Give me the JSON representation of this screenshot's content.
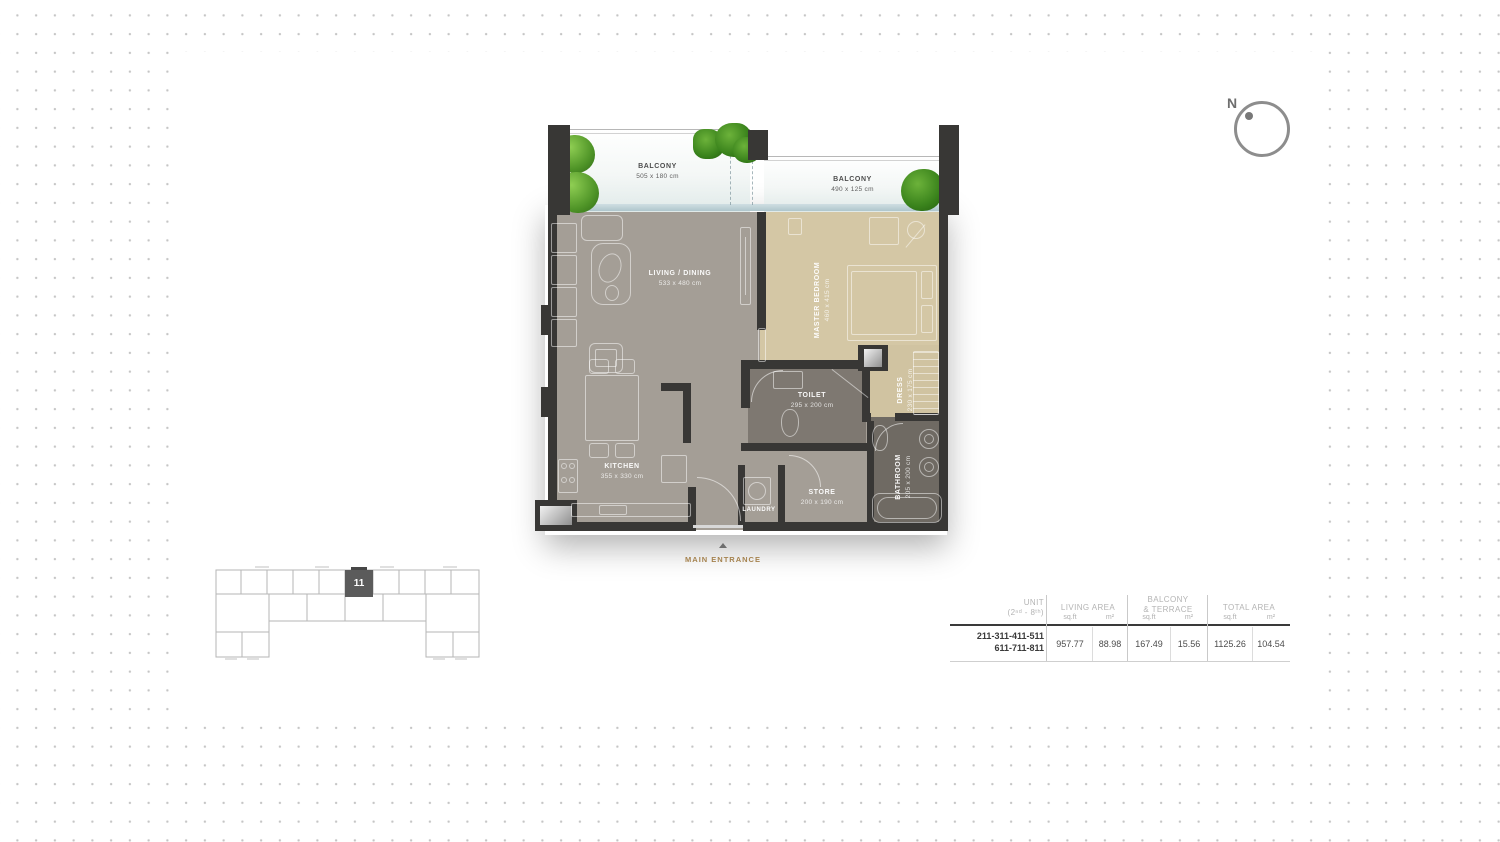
{
  "compass": {
    "label": "N"
  },
  "floorplan": {
    "balcony_left": {
      "name": "BALCONY",
      "dims": "505 x 180 cm"
    },
    "balcony_right": {
      "name": "BALCONY",
      "dims": "490 x 125 cm"
    },
    "living": {
      "name": "LIVING / DINING",
      "dims": "533 x 480 cm"
    },
    "master_bedroom": {
      "name": "MASTER BEDROOM",
      "dims": "460 x 415 cm"
    },
    "kitchen": {
      "name": "KITCHEN",
      "dims": "355 x 330 cm"
    },
    "toilet": {
      "name": "TOILET",
      "dims": "295 x 200 cm"
    },
    "dress": {
      "name": "DRESS",
      "dims": "230 x 175 cm"
    },
    "bathroom": {
      "name": "BATHROOM",
      "dims": "205 x 200 cm"
    },
    "store": {
      "name": "STORE",
      "dims": "200 x 190 cm"
    },
    "laundry": {
      "name": "LAUNDRY"
    },
    "entrance": {
      "label": "MAIN ENTRANCE"
    }
  },
  "keyplan": {
    "unit_marker": "11"
  },
  "area_table": {
    "col_unit": {
      "title": "UNIT",
      "subtitle": "(2ⁿᵈ - 8ᵗʰ)"
    },
    "col_living": {
      "title": "LIVING AREA",
      "sqft_label": "sq.ft",
      "m2_label": "m²"
    },
    "col_balcony": {
      "title_line1": "BALCONY",
      "title_line2": "& TERRACE",
      "sqft_label": "sq.ft",
      "m2_label": "m²"
    },
    "col_total": {
      "title": "TOTAL AREA",
      "sqft_label": "sq.ft",
      "m2_label": "m²"
    },
    "row": {
      "units_line1": "211-311-411-511",
      "units_line2": "611-711-811",
      "living_sqft": "957.77",
      "living_m2": "88.98",
      "balcony_sqft": "167.49",
      "balcony_m2": "15.56",
      "total_sqft": "1125.26",
      "total_m2": "104.54"
    }
  },
  "colors": {
    "wall": "#383735",
    "floor_gray": "#a49e96",
    "floor_tan": "#d4c7a5",
    "floor_toilet": "#7e7871",
    "floor_bath": "#6f6a63",
    "glass": "#b9cdd2",
    "accent_gold": "#a5824e",
    "dot_grid": "#c5c5c5"
  }
}
